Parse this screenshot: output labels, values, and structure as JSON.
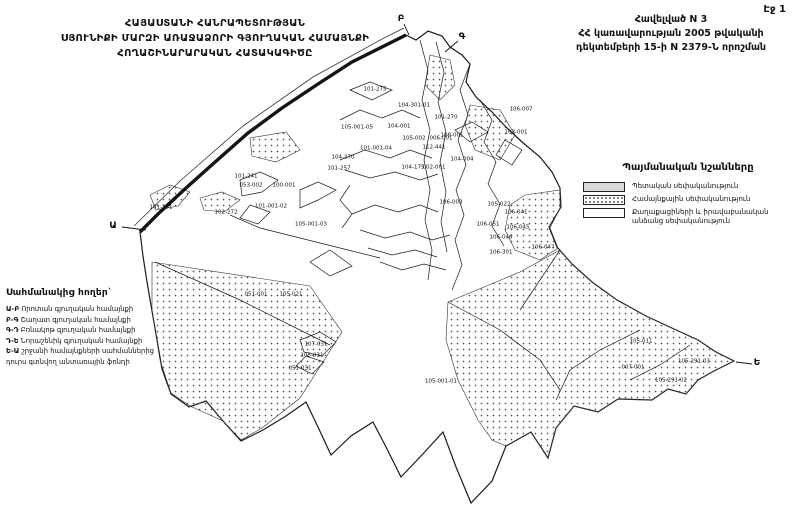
{
  "page": {
    "page_number": "Էջ 1"
  },
  "title_left": {
    "line1": "ՀԱՅԱՍՏԱՆԻ ՀԱՆՐԱՊԵՏՈՒԹՅԱՆ",
    "line2": "ՍՅՈՒՆԻՔԻ ՄԱՐԶԻ ԱՌԱՋԱՁՈՐԻ ԳՅՈՒՂԱԿԱՆ ՀԱՄԱՅՆՔԻ",
    "line3": "ՀՈՂԱՇԻՆԱՐԱՐԱԿԱՆ ՀԱՏԱԿԱԳԻԾԸ"
  },
  "title_right": {
    "line1": "Հավելված N 3",
    "line2": "ՀՀ կառավարության 2005 թվականի",
    "line3": "դեկտեմբերի 15-ի N 2379-Ն որոշման"
  },
  "legend": {
    "title": "Պայմանական նշանները",
    "items": [
      {
        "label": "Պետական սեփականություն",
        "fill": "solid-gray"
      },
      {
        "label": "Համայնքային սեփականություն",
        "fill": "dotted"
      },
      {
        "label": "Քաղաքացիների և իրավաբանական անձանց սեփականություն",
        "fill": "white"
      }
    ]
  },
  "adjacent_lands": {
    "title": "Սահմանակից հողեր`",
    "items": [
      {
        "prefix": "Ա-Բ",
        "label": "Որոտան գյուղական համայնքի"
      },
      {
        "prefix": "Բ-Գ",
        "label": "Շաղատ գյուղական համայնքի"
      },
      {
        "prefix": "Գ-Դ",
        "label": "Բռնակոթ գյուղական համայնքի"
      },
      {
        "prefix": "Դ-Ե",
        "label": "Նորաշենիկ գյուղական համայնքի"
      },
      {
        "prefix": "Ե-Ա",
        "label": "շրջանի համայնքների սահմաններից"
      },
      {
        "prefix": "",
        "label": "դուրս գտնվող անտառային ֆոնդի"
      }
    ]
  },
  "map": {
    "corner_letters": [
      {
        "text": "Ա",
        "x": 113,
        "y": 226
      },
      {
        "text": "Բ",
        "x": 401,
        "y": 19
      },
      {
        "text": "Գ",
        "x": 462,
        "y": 37
      },
      {
        "text": "Ե",
        "x": 757,
        "y": 363
      }
    ],
    "parcel_labels": [
      {
        "text": "101-275",
        "x": 375,
        "y": 90
      },
      {
        "text": "104-301-01",
        "x": 414,
        "y": 106
      },
      {
        "text": "101-270",
        "x": 446,
        "y": 118
      },
      {
        "text": "105-001-05",
        "x": 357,
        "y": 128
      },
      {
        "text": "104-001",
        "x": 399,
        "y": 127
      },
      {
        "text": "105-002",
        "x": 414,
        "y": 139
      },
      {
        "text": "006-001",
        "x": 441,
        "y": 139
      },
      {
        "text": "112-441",
        "x": 434,
        "y": 148
      },
      {
        "text": "101-001-04",
        "x": 376,
        "y": 149
      },
      {
        "text": "104-270",
        "x": 343,
        "y": 158
      },
      {
        "text": "101-257",
        "x": 339,
        "y": 169
      },
      {
        "text": "104-175",
        "x": 413,
        "y": 168
      },
      {
        "text": "002-001",
        "x": 434,
        "y": 168
      },
      {
        "text": "103-001",
        "x": 516,
        "y": 133
      },
      {
        "text": "108-001",
        "x": 452,
        "y": 136
      },
      {
        "text": "106-007",
        "x": 521,
        "y": 110
      },
      {
        "text": "104-004",
        "x": 462,
        "y": 160
      },
      {
        "text": "101-251",
        "x": 161,
        "y": 208
      },
      {
        "text": "101-241",
        "x": 246,
        "y": 177
      },
      {
        "text": "053-002",
        "x": 251,
        "y": 186
      },
      {
        "text": "100-001",
        "x": 284,
        "y": 186
      },
      {
        "text": "101-001-02",
        "x": 271,
        "y": 207
      },
      {
        "text": "102-272",
        "x": 226,
        "y": 213
      },
      {
        "text": "105-001-03",
        "x": 311,
        "y": 225
      },
      {
        "text": "106-003",
        "x": 451,
        "y": 203
      },
      {
        "text": "105-022",
        "x": 499,
        "y": 205
      },
      {
        "text": "106-041",
        "x": 516,
        "y": 213
      },
      {
        "text": "106-051",
        "x": 488,
        "y": 225
      },
      {
        "text": "106-045",
        "x": 518,
        "y": 228
      },
      {
        "text": "106-046",
        "x": 501,
        "y": 238
      },
      {
        "text": "106-047",
        "x": 543,
        "y": 248
      },
      {
        "text": "106-301",
        "x": 501,
        "y": 253
      },
      {
        "text": "051-001",
        "x": 256,
        "y": 295
      },
      {
        "text": "105-021",
        "x": 291,
        "y": 295
      },
      {
        "text": "107-031",
        "x": 316,
        "y": 345
      },
      {
        "text": "105-031",
        "x": 312,
        "y": 356
      },
      {
        "text": "051-031",
        "x": 300,
        "y": 369
      },
      {
        "text": "105-001-01",
        "x": 441,
        "y": 382
      },
      {
        "text": "007-001",
        "x": 633,
        "y": 368
      },
      {
        "text": "105-291-03",
        "x": 694,
        "y": 362
      },
      {
        "text": "105-291-02",
        "x": 671,
        "y": 381
      },
      {
        "text": "105-011",
        "x": 641,
        "y": 342
      }
    ]
  }
}
